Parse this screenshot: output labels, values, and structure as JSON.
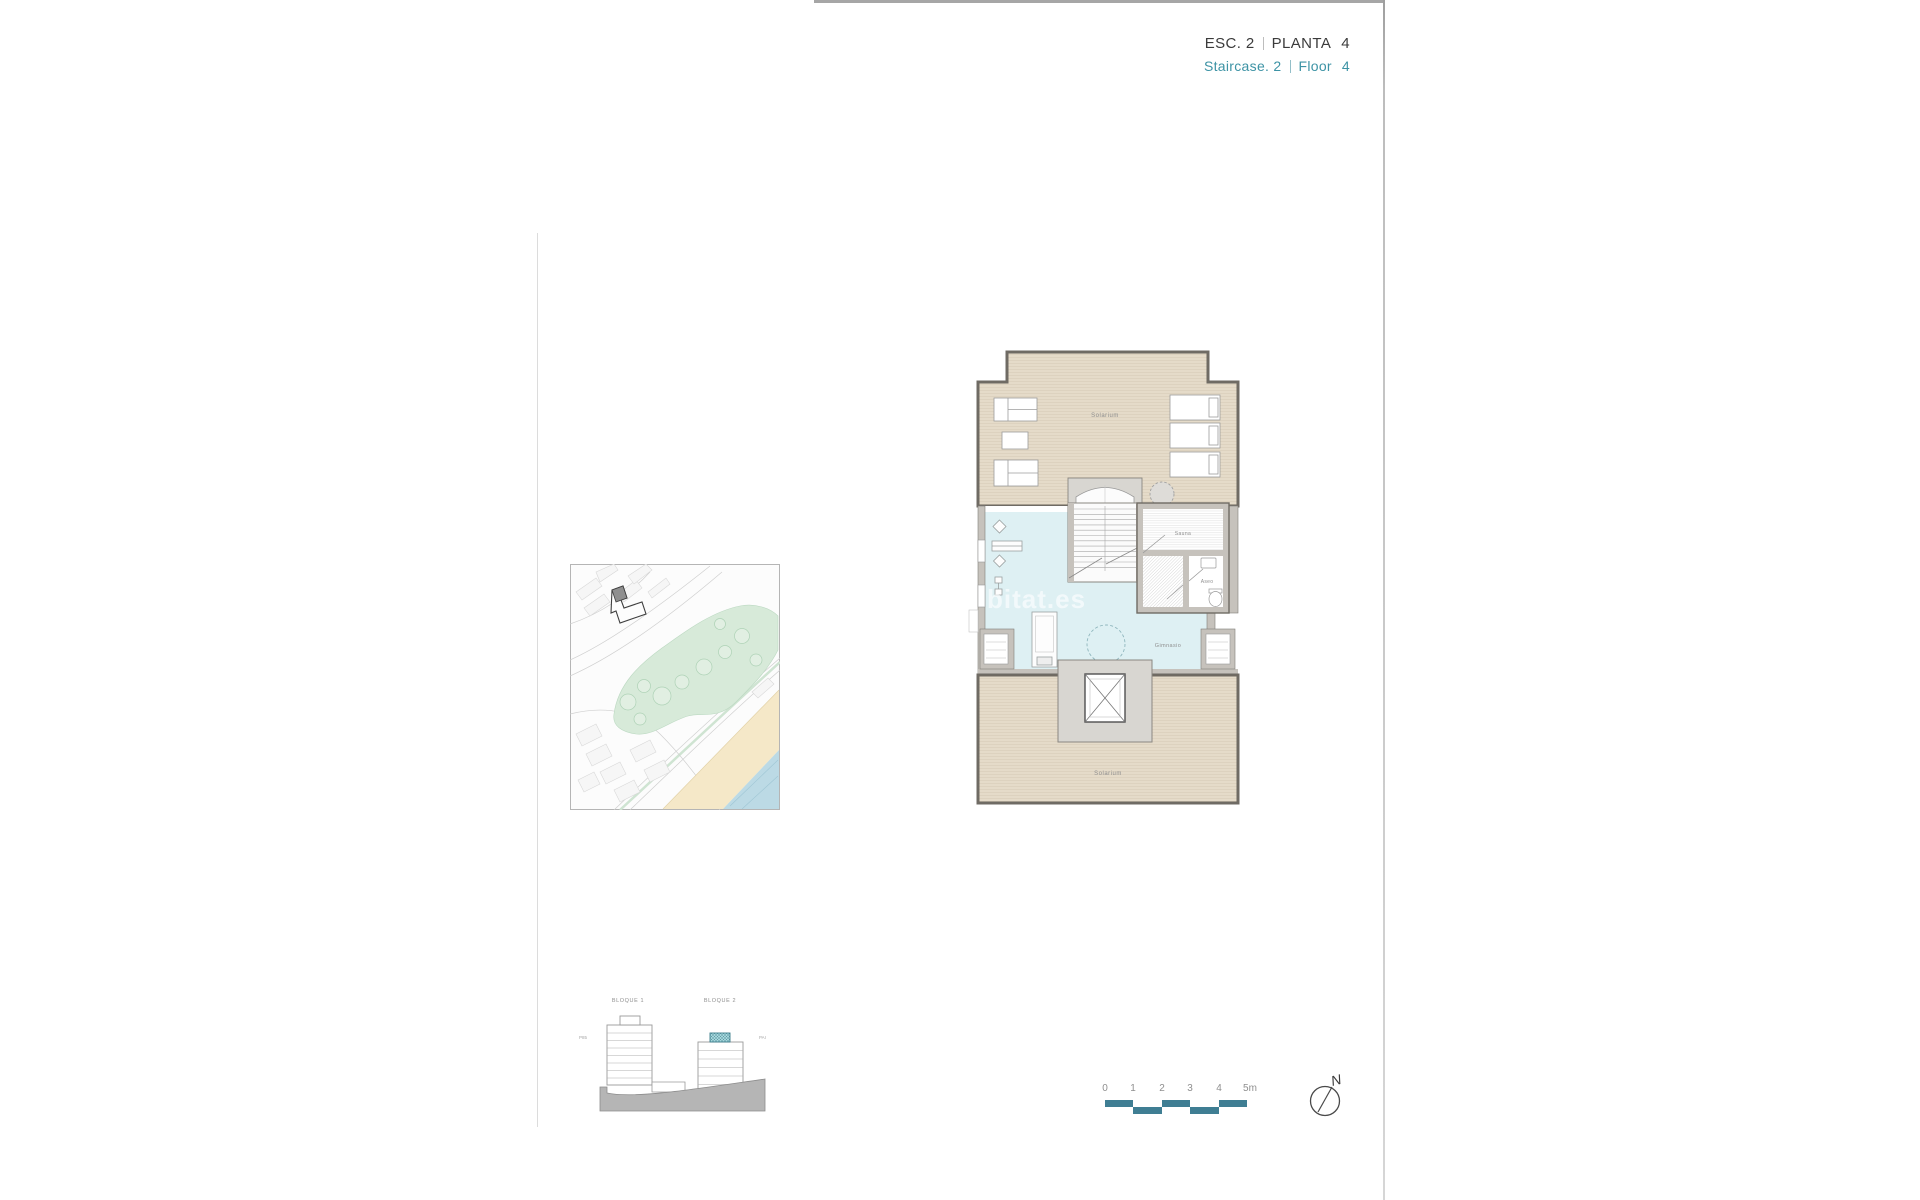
{
  "header": {
    "line1": {
      "esc_label": "ESC. 2",
      "planta_label": "PLANTA",
      "planta_value": "4"
    },
    "line2": {
      "staircase_label": "Staircase. 2",
      "floor_label": "Floor",
      "floor_value": "4"
    },
    "primary_color": "#3b3b3b",
    "accent_color": "#3d93a5"
  },
  "floor_plan": {
    "rooms": {
      "solarium_top": "Solarium",
      "sauna": "Sauna",
      "aseo": "Aseo",
      "gimnasio": "Gimnasio",
      "solarium_bottom": "Solarium"
    },
    "watermark": "bitat.es",
    "colors": {
      "solarium_floor": "#e5dbc9",
      "gym_floor": "#def0f3",
      "wall_fill": "#c6c2bc",
      "wall_outline": "#6f6b64"
    }
  },
  "site_map": {
    "colors": {
      "park": "#d7ead9",
      "beach": "#f5e8c8",
      "sea": "#bcdae5",
      "streets": "#cfcfcf",
      "highlight_building": "#8f8f8f"
    }
  },
  "elevation": {
    "bloque1_label": "BLOQUE 1",
    "bloque2_label": "BLOQUE 2",
    "left_note": "P85",
    "right_note": "PAI",
    "highlight_color": "#a5d8dd"
  },
  "scale_bar": {
    "ticks": [
      "0",
      "1",
      "2",
      "3",
      "4",
      "5m"
    ],
    "bar_color": "#3f7e93"
  },
  "compass": {
    "north_label": "N"
  }
}
